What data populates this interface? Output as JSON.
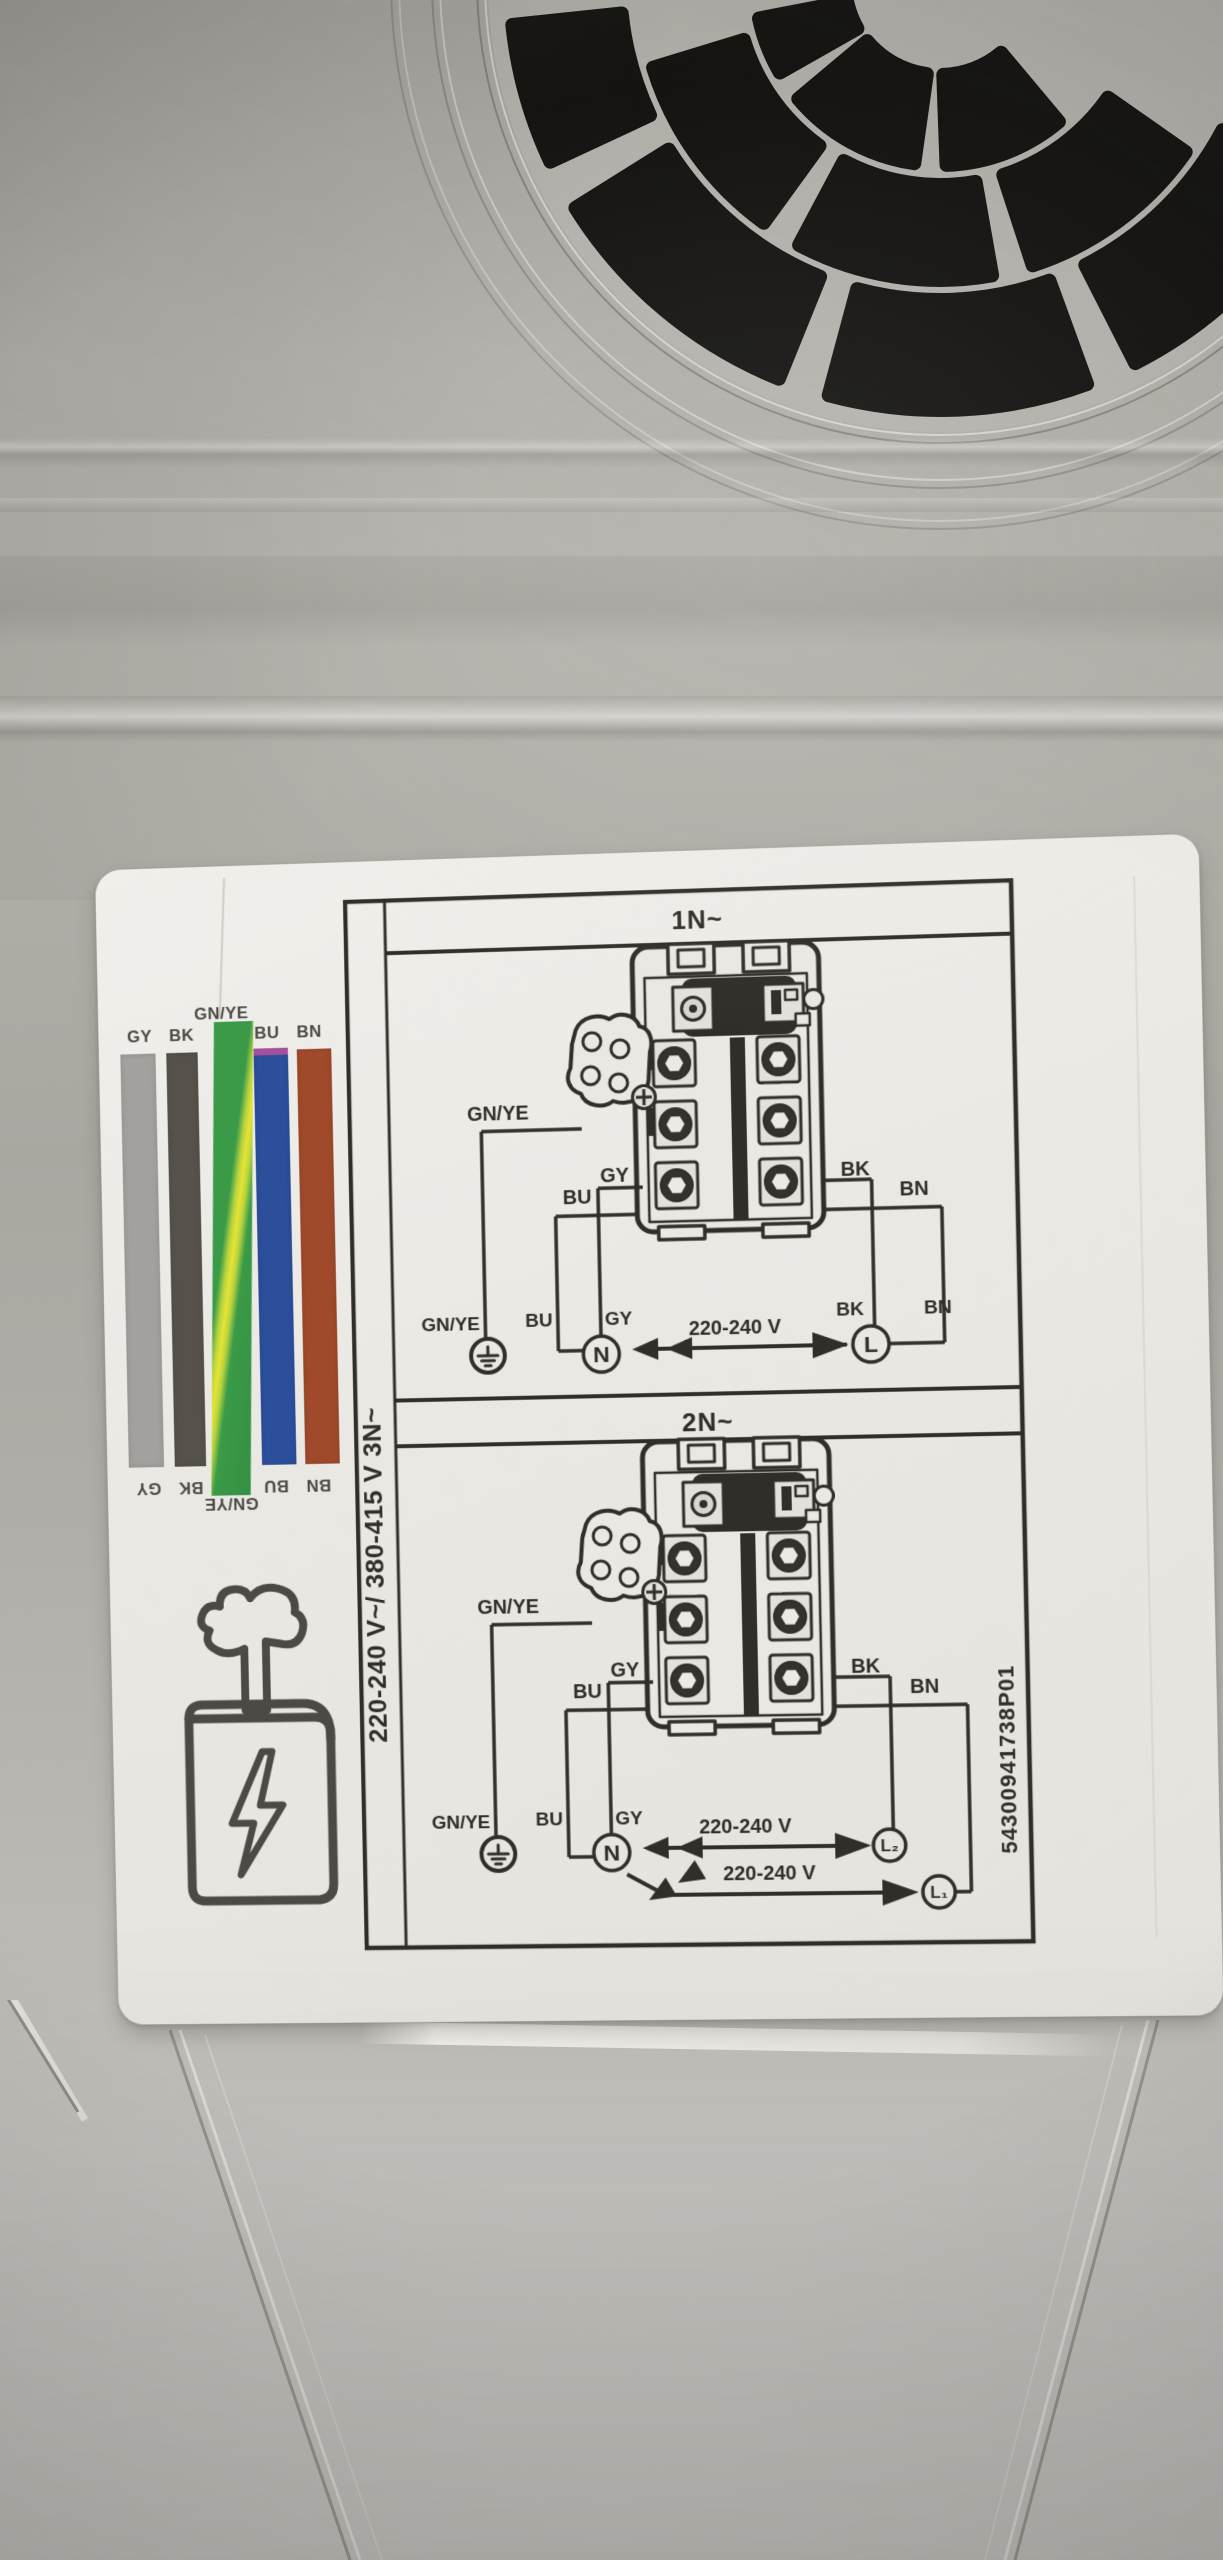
{
  "sticker": {
    "color_key": {
      "top_labels": [
        "GY",
        "BK",
        "GN/YE",
        "BU",
        "BN"
      ],
      "bottom_labels": [
        "GY",
        "BK",
        "GN/YE",
        "BU",
        "BN"
      ],
      "colors": {
        "GY": "#a2a19e",
        "BK": "#56524b",
        "GN_YE_green": "#3a9a47",
        "GN_YE_yellow": "#e6e432",
        "BU": "#2c4f9c",
        "BU_top_edge": "#a4509e",
        "BN": "#a04a2b"
      }
    },
    "rating_text": "220-240 V~/ 380-415 V 3N~",
    "part_number": "54300941738P01",
    "ink_color": "#312e29",
    "diagrams": [
      {
        "title": "1N~",
        "upper": {
          "gnye": "GN/YE",
          "bu": "BU",
          "gy": "GY",
          "bk": "BK",
          "bn": "BN"
        },
        "lower": {
          "gnye": "GN/YE",
          "bu": "BU",
          "gy": "GY",
          "bk": "BK",
          "bn": "BN"
        },
        "terminals": {
          "neutral": "N",
          "line": "L"
        },
        "voltage": "220-240 V"
      },
      {
        "title": "2N~",
        "upper": {
          "gnye": "GN/YE",
          "bu": "BU",
          "gy": "GY",
          "bk": "BK",
          "bn": "BN"
        },
        "lower": {
          "gnye": "GN/YE",
          "bu": "BU",
          "gy": "GY"
        },
        "terminals": {
          "neutral": "N",
          "line2": "L₂",
          "line1": "L₁"
        },
        "voltage_l2": "220-240 V",
        "voltage_l1": "220-240 V"
      }
    ]
  }
}
